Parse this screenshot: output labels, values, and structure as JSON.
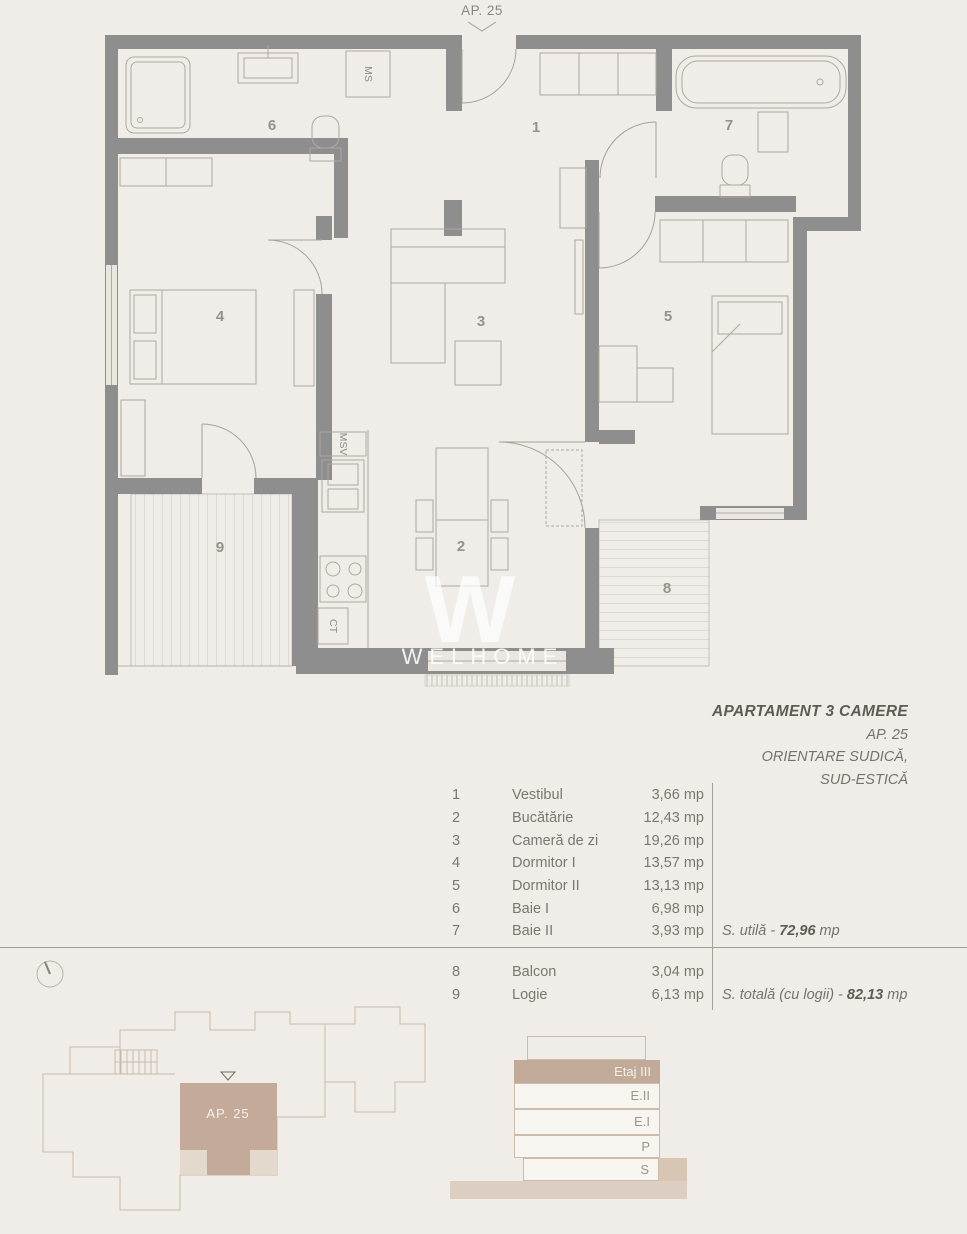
{
  "plan": {
    "entrance_label": "AP. 25",
    "watermark_w": "W",
    "watermark_name": "WELHOME",
    "labels": {
      "ms": "MS",
      "msv": "MSV",
      "ct": "CT"
    },
    "room_numbers": [
      "1",
      "2",
      "3",
      "4",
      "5",
      "6",
      "7",
      "8",
      "9"
    ]
  },
  "legend": {
    "title": "APARTAMENT 3 CAMERE",
    "ap": "AP. 25",
    "orientation1": "ORIENTARE SUDICĂ,",
    "orientation2": "SUD-ESTICĂ"
  },
  "rooms": [
    {
      "num": "1",
      "name": "Vestibul",
      "area": "3,66 mp"
    },
    {
      "num": "2",
      "name": "Bucătărie",
      "area": "12,43 mp"
    },
    {
      "num": "3",
      "name": "Cameră de zi",
      "area": "19,26 mp"
    },
    {
      "num": "4",
      "name": "Dormitor I",
      "area": "13,57 mp"
    },
    {
      "num": "5",
      "name": "Dormitor II",
      "area": "13,13 mp"
    },
    {
      "num": "6",
      "name": "Baie I",
      "area": "6,98 mp"
    },
    {
      "num": "7",
      "name": "Baie II",
      "area": "3,93 mp"
    }
  ],
  "annex": [
    {
      "num": "8",
      "name": "Balcon",
      "area": "3,04 mp"
    },
    {
      "num": "9",
      "name": "Logie",
      "area": "6,13 mp"
    }
  ],
  "totals": {
    "useful_prefix": "S. utilă - ",
    "useful_value": "72,96",
    "useful_suffix": " mp",
    "total_prefix": "S. totală (cu logii) - ",
    "total_value": "82,13",
    "total_suffix": " mp"
  },
  "site_plan": {
    "unit_label": "AP. 25"
  },
  "section": {
    "floors": [
      "Etaj III",
      "E.II",
      "E.I",
      "P",
      "S"
    ]
  },
  "colors": {
    "wall": "#8e8e8e",
    "accent_tan": "#c4ab99",
    "rule": "#a39d96"
  }
}
